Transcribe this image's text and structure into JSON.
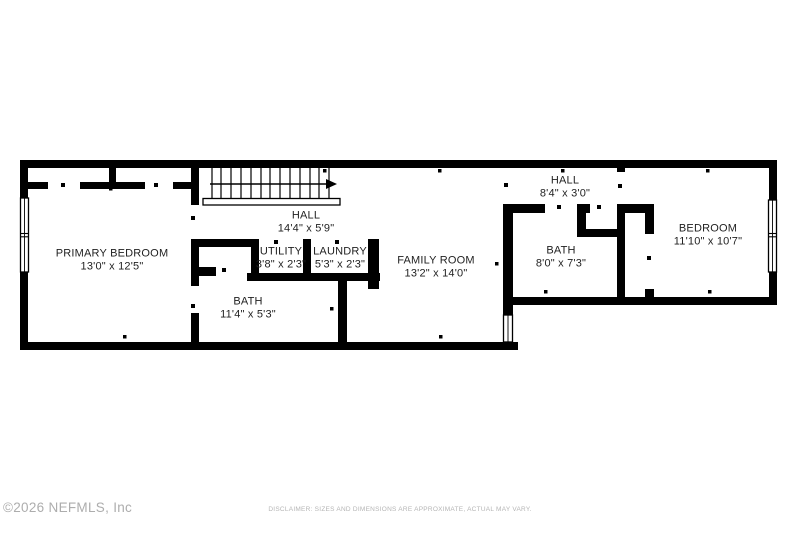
{
  "floorplan": {
    "rooms": [
      {
        "id": "primary-bedroom",
        "name": "PRIMARY BEDROOM",
        "dims": "13'0\" x 12'5\""
      },
      {
        "id": "hall-main",
        "name": "HALL",
        "dims": "14'4\" x 5'9\""
      },
      {
        "id": "utility",
        "name": "UTILITY",
        "dims": "3'8\" x 2'3\""
      },
      {
        "id": "laundry",
        "name": "LAUNDRY",
        "dims": "5'3\" x 2'3\""
      },
      {
        "id": "bath-primary",
        "name": "BATH",
        "dims": "11'4\" x 5'3\""
      },
      {
        "id": "family-room",
        "name": "FAMILY ROOM",
        "dims": "13'2\" x 14'0\""
      },
      {
        "id": "hall-upper",
        "name": "HALL",
        "dims": "8'4\" x 3'0\""
      },
      {
        "id": "bath-second",
        "name": "BATH",
        "dims": "8'0\" x 7'3\""
      },
      {
        "id": "bedroom",
        "name": "BEDROOM",
        "dims": "11'10\" x 10'7\""
      }
    ],
    "icons": {
      "windows": "window-symbol",
      "stairs": "stairs-symbol",
      "stairs_arrow_direction": "right"
    }
  },
  "footer": {
    "copyright": "©2026 NEFMLS, Inc",
    "disclaimer": "DISCLAIMER: SIZES AND DIMENSIONS ARE APPROXIMATE, ACTUAL MAY VARY."
  },
  "colors": {
    "wall": "#000000",
    "label_text": "#1f1f1f",
    "footer_copyright": "#adadad",
    "footer_disclaimer": "#b5b5b5",
    "background": "#ffffff"
  }
}
